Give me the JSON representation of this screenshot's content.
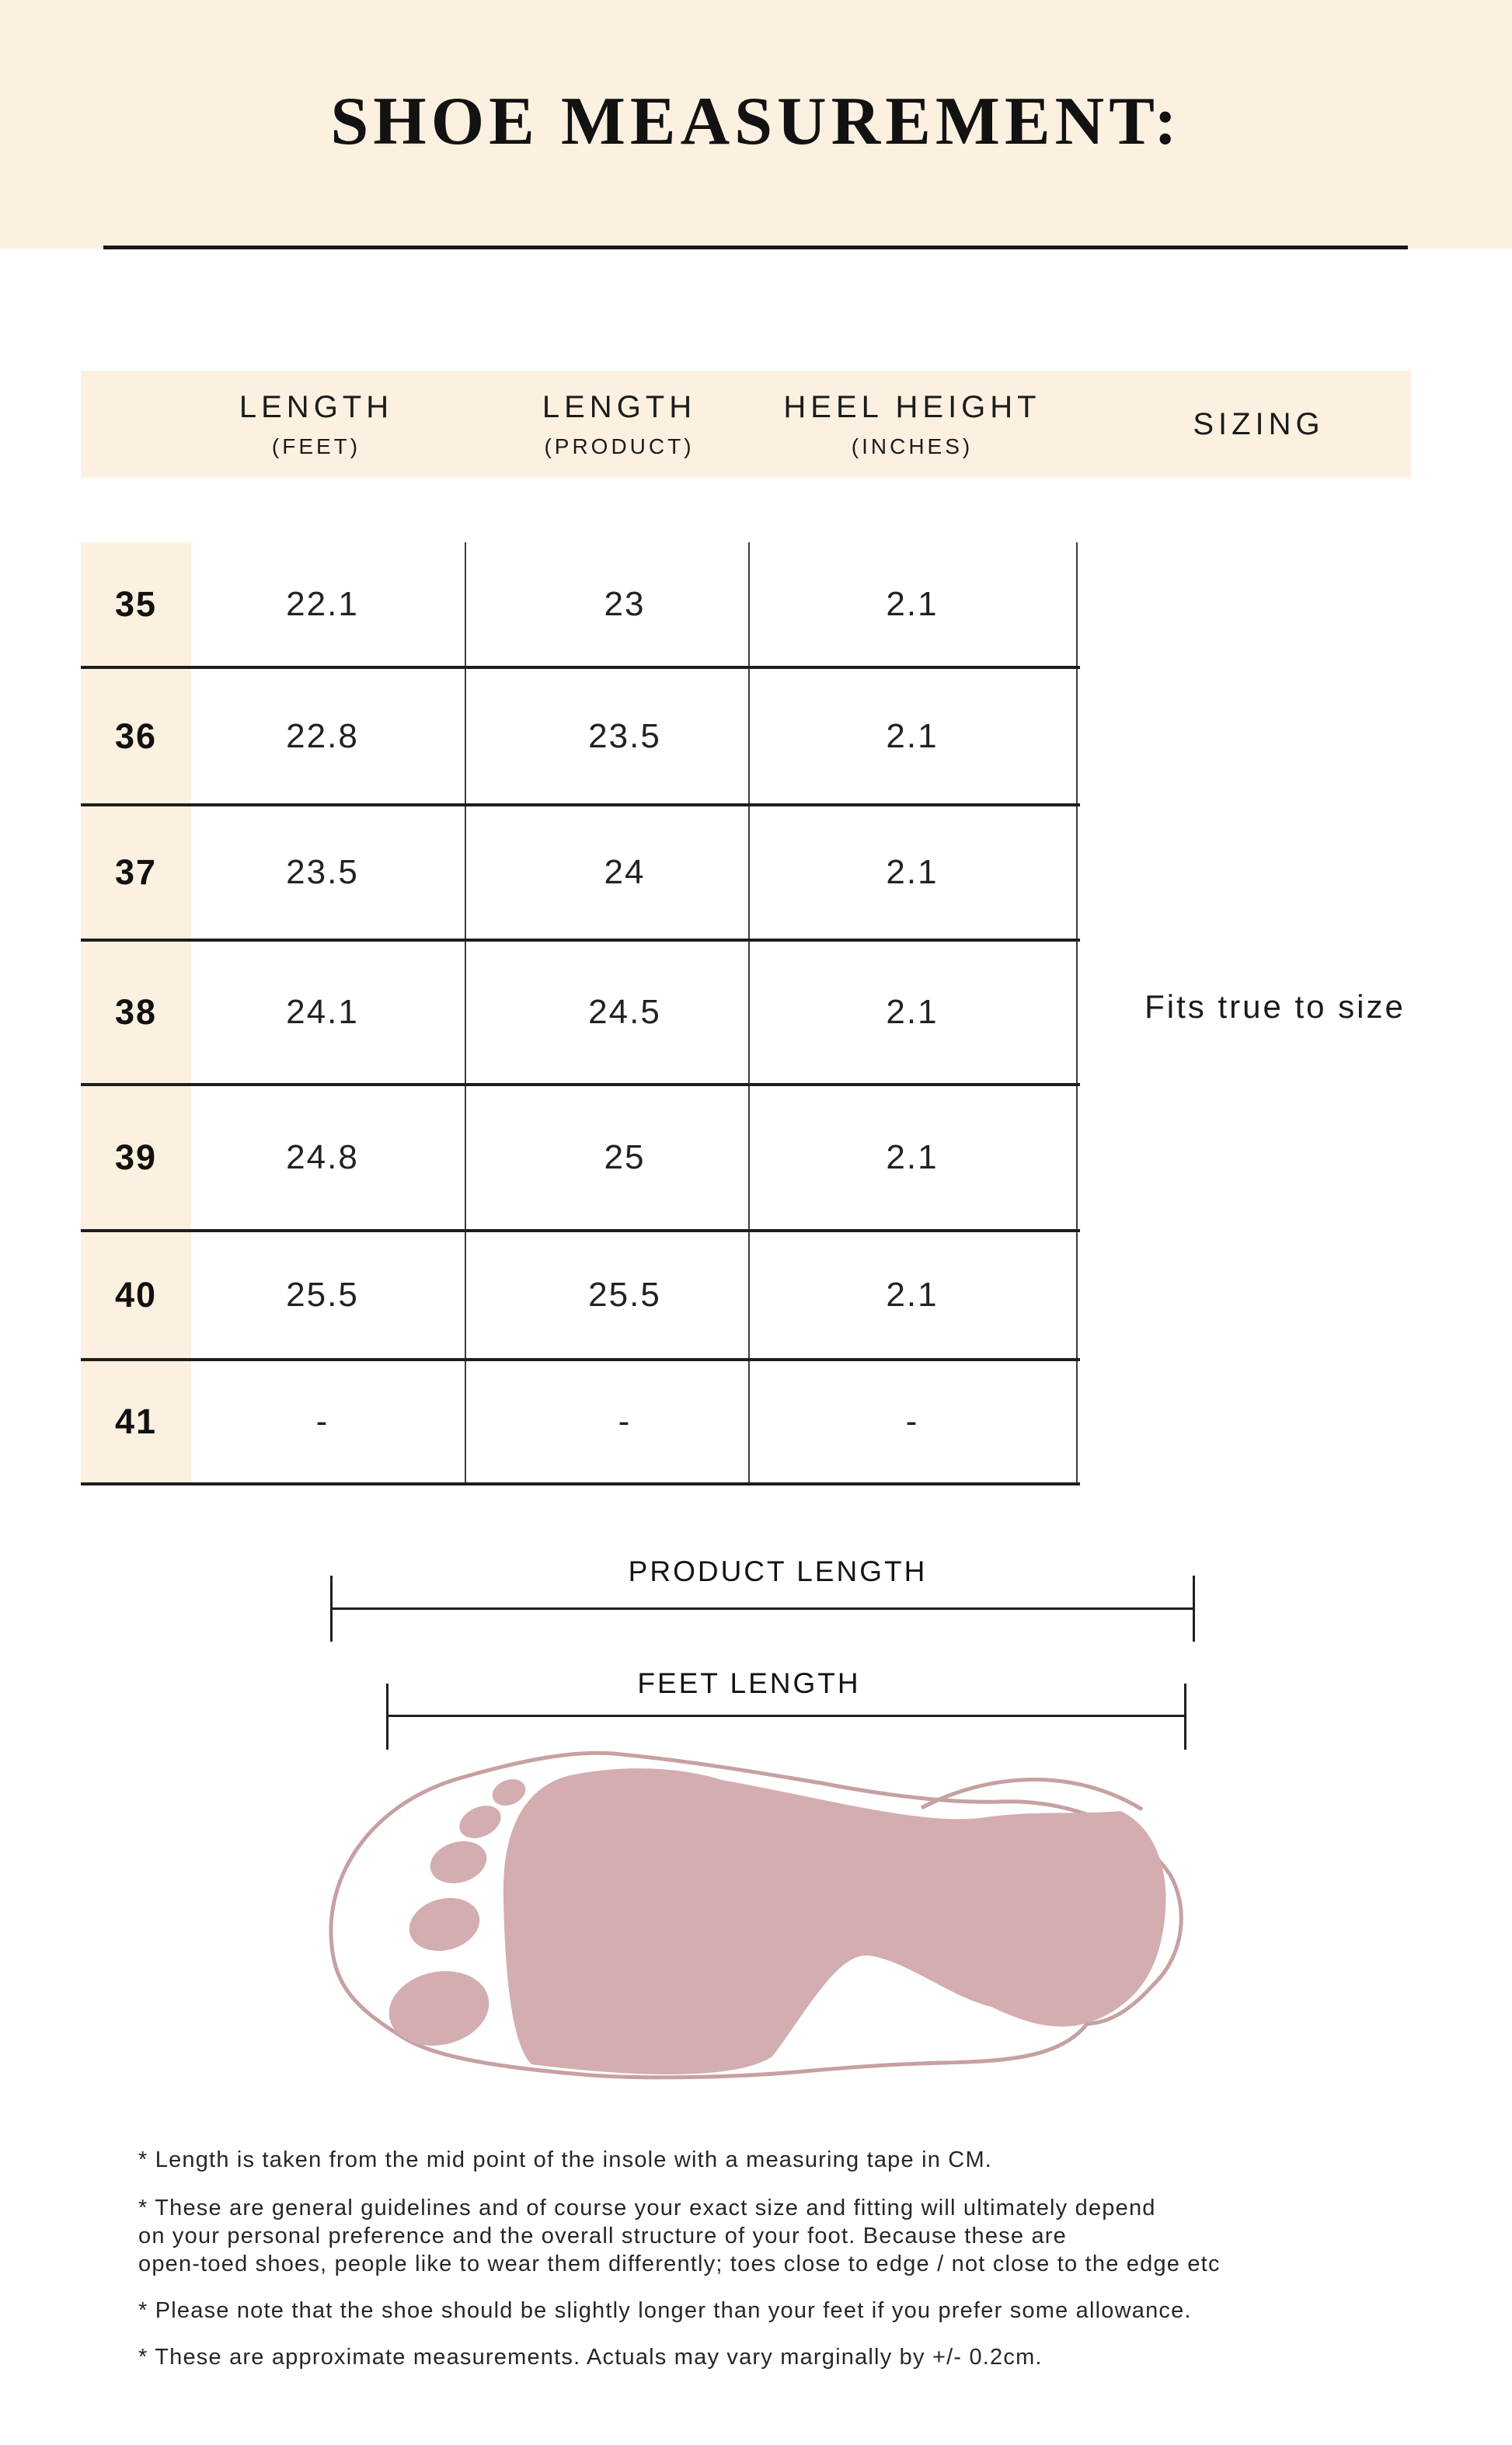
{
  "title": "SHOE MEASUREMENT:",
  "colors": {
    "cream_background": "#FCF1E1",
    "table_line": "#1D1D1D",
    "foot_fill": "#D3ADAF",
    "foot_outline": "#C7A0A2"
  },
  "table": {
    "headers": [
      {
        "main": "LENGTH",
        "sub": "(FEET)"
      },
      {
        "main": "LENGTH",
        "sub": "(PRODUCT)"
      },
      {
        "main": "HEEL HEIGHT",
        "sub": "(INCHES)"
      },
      {
        "main": "SIZING",
        "sub": ""
      }
    ],
    "rows": [
      {
        "size": "35",
        "feet": "22.1",
        "product": "23",
        "heel": "2.1"
      },
      {
        "size": "36",
        "feet": "22.8",
        "product": "23.5",
        "heel": "2.1"
      },
      {
        "size": "37",
        "feet": "23.5",
        "product": "24",
        "heel": "2.1"
      },
      {
        "size": "38",
        "feet": "24.1",
        "product": "24.5",
        "heel": "2.1"
      },
      {
        "size": "39",
        "feet": "24.8",
        "product": "25",
        "heel": "2.1"
      },
      {
        "size": "40",
        "feet": "25.5",
        "product": "25.5",
        "heel": "2.1"
      },
      {
        "size": "41",
        "feet": "-",
        "product": "-",
        "heel": "-"
      }
    ],
    "sizing_note": "Fits true to size"
  },
  "diagram": {
    "product_length_label": "PRODUCT LENGTH",
    "feet_length_label": "FEET LENGTH"
  },
  "footnotes": [
    {
      "lines": [
        "* Length is taken from the mid point of the insole with a measuring tape in CM."
      ]
    },
    {
      "lines": [
        "* These are general guidelines and of course your exact size and fitting will ultimately depend",
        "on your personal preference and the overall structure of your foot. Because these are",
        "open-toed shoes, people like to wear them differently; toes close to edge / not close to the edge etc"
      ]
    },
    {
      "lines": [
        "* Please note that the shoe should be slightly longer than your feet if you prefer some allowance."
      ]
    },
    {
      "lines": [
        "* These are approximate measurements. Actuals may vary marginally by +/- 0.2cm."
      ]
    }
  ]
}
